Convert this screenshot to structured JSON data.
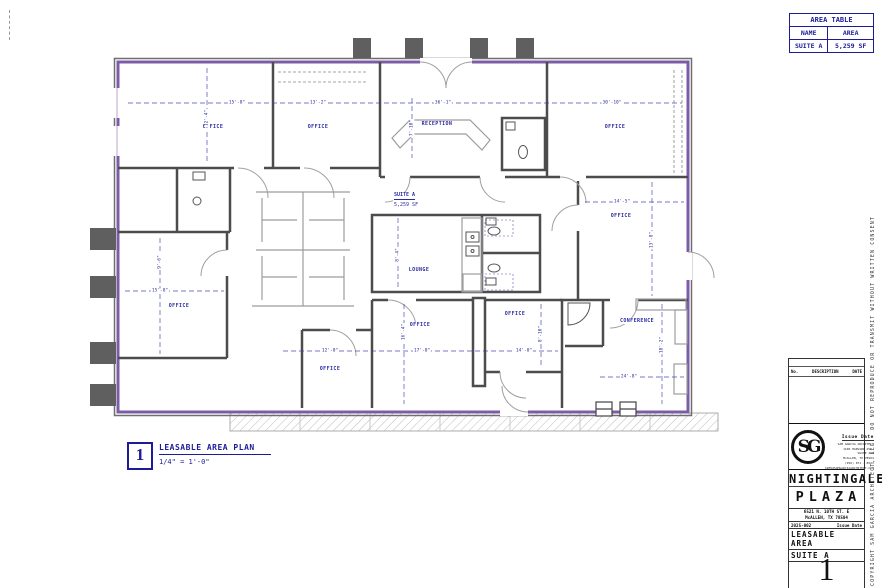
{
  "colors": {
    "wall": "#4c4c4c",
    "exterior_wall": "#7c5ca6",
    "annotation": "#2a2aa0",
    "furniture": "#9c9c9c"
  },
  "area_table": {
    "title": "AREA TABLE",
    "col_name": "NAME",
    "col_area": "AREA",
    "rows": [
      {
        "name": "SUITE A",
        "area": "5,259 SF"
      }
    ]
  },
  "plan": {
    "suite_name": "SUITE A",
    "suite_area": "5,259 SF",
    "rooms": [
      {
        "label": "OFFICE",
        "x": 213,
        "y": 127
      },
      {
        "label": "OFFICE",
        "x": 318,
        "y": 127
      },
      {
        "label": "RECEPTION",
        "x": 437,
        "y": 124
      },
      {
        "label": "OFFICE",
        "x": 615,
        "y": 127
      },
      {
        "label": "OFFICE",
        "x": 621,
        "y": 216
      },
      {
        "label": "CONFERENCE",
        "x": 637,
        "y": 321
      },
      {
        "label": "LOUNGE",
        "x": 419,
        "y": 270
      },
      {
        "label": "OFFICE",
        "x": 179,
        "y": 306
      },
      {
        "label": "OFFICE",
        "x": 420,
        "y": 325
      },
      {
        "label": "OFFICE",
        "x": 515,
        "y": 314
      },
      {
        "label": "OFFICE",
        "x": 330,
        "y": 369
      }
    ],
    "dimensions": [
      {
        "text": "15'-8\"",
        "x": 237,
        "y": 103
      },
      {
        "text": "13'-2\"",
        "x": 318,
        "y": 103
      },
      {
        "text": "36'-1\"",
        "x": 443,
        "y": 103
      },
      {
        "text": "30'-10\"",
        "x": 612,
        "y": 103
      },
      {
        "text": "12'-4\"",
        "x": 207,
        "y": 118,
        "vertical": true
      },
      {
        "text": "7'-10\"",
        "x": 412,
        "y": 128,
        "vertical": true
      },
      {
        "text": "14'-5\"",
        "x": 622,
        "y": 202
      },
      {
        "text": "13'-8\"",
        "x": 652,
        "y": 240,
        "vertical": true
      },
      {
        "text": "15'-8\"",
        "x": 160,
        "y": 291
      },
      {
        "text": "9'-6\"",
        "x": 160,
        "y": 262,
        "vertical": true
      },
      {
        "text": "12'-0\"",
        "x": 330,
        "y": 351
      },
      {
        "text": "17'-0\"",
        "x": 422,
        "y": 351
      },
      {
        "text": "14'-0\"",
        "x": 524,
        "y": 351
      },
      {
        "text": "16'-4\"",
        "x": 404,
        "y": 332,
        "vertical": true
      },
      {
        "text": "8'-10\"",
        "x": 541,
        "y": 334,
        "vertical": true
      },
      {
        "text": "24'-8\"",
        "x": 629,
        "y": 377
      },
      {
        "text": "18'-2\"",
        "x": 662,
        "y": 345,
        "vertical": true
      },
      {
        "text": "8'-4\"",
        "x": 398,
        "y": 255,
        "vertical": true
      }
    ]
  },
  "drawing_title": {
    "number": "1",
    "title": "LEASABLE AREA PLAN",
    "scale": "1/4\" = 1'-0\""
  },
  "title_block": {
    "rev_no": "No.",
    "rev_desc": "DESCRIPTION",
    "rev_date": "DATE",
    "issue_label": "Issue Date",
    "logo_text": "SG",
    "architect": {
      "name": "SAM GARCIA ARCHITECT",
      "address1": "1100 HARVARD AVE.",
      "address2": "SUITE 205",
      "city": "McALLEN, TX 78504",
      "phone": "(956) 871 - 8523",
      "email": "INFO@SAMGARCIAARCHITECT.COM"
    },
    "project_line1": "NIGHTINGALE",
    "project_line2": "PLAZA",
    "address1": "6521 N. 10TH ST. E",
    "address2": "McALLEN, TX 78504",
    "project_number": "2025-002",
    "issue_label2": "Issue Date",
    "sheet_title1": "LEASABLE AREA",
    "sheet_title2": "SUITE A",
    "sheet_number": "1",
    "copyright": "COPYRIGHT SAM GARCIA ARCHITECT, LLC - DO NOT REPRODUCE OR TRANSMIT WITHOUT WRITTEN CONSENT"
  }
}
